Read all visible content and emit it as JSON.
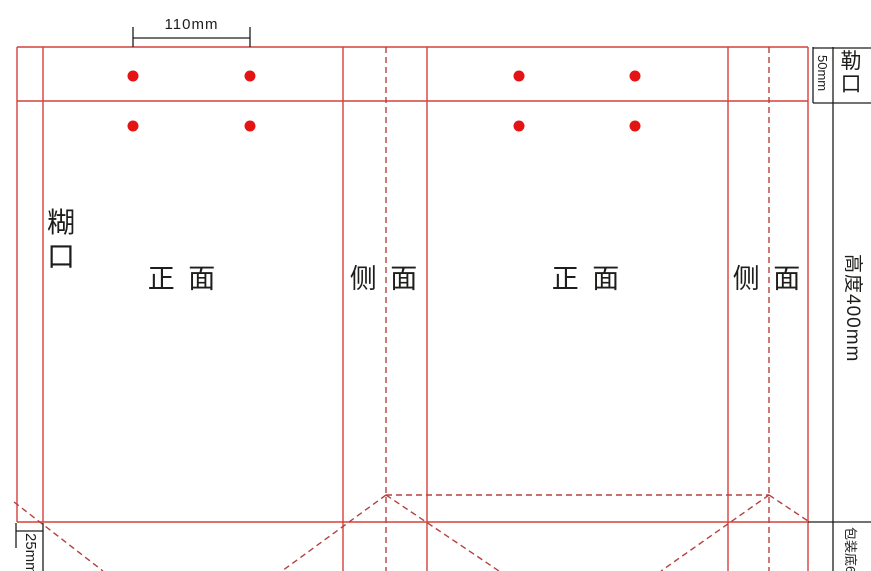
{
  "colors": {
    "red_line": "#d6403c",
    "red_dash": "#b5413f",
    "dot": "#e41414",
    "black": "#1d1d1b"
  },
  "labels": {
    "top_dimension": "110mm",
    "lekou": "勒口",
    "lekou_height": "50mm",
    "glue_flap": "糊口",
    "glue_flap_width": "25mm",
    "front_panel_1": "正 面",
    "side_panel_1": "侧 面",
    "front_panel_2": "正 面",
    "side_panel_2": "侧 面",
    "bag_height": "高度400mm",
    "bag_bottom": "包装底65"
  },
  "diagram": {
    "width": 871,
    "height": 571,
    "lines": [
      {
        "name": "top-edge-fold-line",
        "x1": 17,
        "y1": 47,
        "x2": 808,
        "y2": 47,
        "color": "red_line",
        "dashed": false
      },
      {
        "name": "lekou-fold-line",
        "x1": 17,
        "y1": 101,
        "x2": 808,
        "y2": 101,
        "color": "red_line",
        "dashed": false
      },
      {
        "name": "bottom-fold-line",
        "x1": 17,
        "y1": 522,
        "x2": 808,
        "y2": 522,
        "color": "red_line",
        "dashed": false
      },
      {
        "name": "glue-flap-left-edge",
        "x1": 17,
        "y1": 47,
        "x2": 17,
        "y2": 522,
        "color": "red_line",
        "dashed": false
      },
      {
        "name": "glue-flap-fold-line",
        "x1": 43,
        "y1": 47,
        "x2": 43,
        "y2": 522,
        "color": "red_line",
        "dashed": false
      },
      {
        "name": "front1-side1-fold-line",
        "x1": 343,
        "y1": 47,
        "x2": 343,
        "y2": 571,
        "color": "red_line",
        "dashed": false
      },
      {
        "name": "side1-front2-fold-line",
        "x1": 427,
        "y1": 47,
        "x2": 427,
        "y2": 571,
        "color": "red_line",
        "dashed": false
      },
      {
        "name": "front2-side2-fold-line",
        "x1": 728,
        "y1": 47,
        "x2": 728,
        "y2": 571,
        "color": "red_line",
        "dashed": false
      },
      {
        "name": "right-edge-cut-line",
        "x1": 808,
        "y1": 47,
        "x2": 808,
        "y2": 571,
        "color": "red_line",
        "dashed": false
      },
      {
        "name": "side1-center-fold-dashed",
        "x1": 386,
        "y1": 47,
        "x2": 386,
        "y2": 571,
        "color": "red_dash",
        "dashed": true
      },
      {
        "name": "side2-center-fold-dashed",
        "x1": 769,
        "y1": 47,
        "x2": 769,
        "y2": 571,
        "color": "red_dash",
        "dashed": true
      },
      {
        "name": "bottom-gusset-dashed",
        "x1": 386,
        "y1": 495,
        "x2": 769,
        "y2": 495,
        "color": "red_dash",
        "dashed": true
      },
      {
        "name": "glue-corner-diagonal-dashed",
        "x1": 14,
        "y1": 502,
        "x2": 103,
        "y2": 571,
        "color": "red_dash",
        "dashed": true
      },
      {
        "name": "apex1-left-diagonal-dashed",
        "x1": 386,
        "y1": 495,
        "x2": 282,
        "y2": 571,
        "color": "red_dash",
        "dashed": true
      },
      {
        "name": "apex1-right-diagonal-dashed",
        "x1": 386,
        "y1": 495,
        "x2": 499,
        "y2": 571,
        "color": "red_dash",
        "dashed": true
      },
      {
        "name": "apex2-left-diagonal-dashed",
        "x1": 769,
        "y1": 495,
        "x2": 661,
        "y2": 571,
        "color": "red_dash",
        "dashed": true
      },
      {
        "name": "apex2-right-diagonal-dashed",
        "x1": 769,
        "y1": 495,
        "x2": 808,
        "y2": 521,
        "color": "red_dash",
        "dashed": true
      },
      {
        "name": "annotation-right-vertical",
        "x1": 833,
        "y1": 47,
        "x2": 833,
        "y2": 571,
        "color": "black",
        "dashed": false
      },
      {
        "name": "lekou-bracket-vertical",
        "x1": 813,
        "y1": 47,
        "x2": 813,
        "y2": 103,
        "color": "black",
        "dashed": false
      },
      {
        "name": "lekou-bracket-top",
        "x1": 813,
        "y1": 48,
        "x2": 871,
        "y2": 48,
        "color": "black",
        "dashed": false
      },
      {
        "name": "lekou-bracket-bottom",
        "x1": 813,
        "y1": 103,
        "x2": 871,
        "y2": 103,
        "color": "black",
        "dashed": false
      },
      {
        "name": "bottom-annotation-horizontal",
        "x1": 808,
        "y1": 522,
        "x2": 871,
        "y2": 522,
        "color": "black",
        "dashed": false
      },
      {
        "name": "dim110-line",
        "x1": 133,
        "y1": 38,
        "x2": 250,
        "y2": 38,
        "color": "black",
        "dashed": false
      },
      {
        "name": "dim110-left-tick",
        "x1": 133,
        "y1": 27,
        "x2": 133,
        "y2": 47,
        "color": "black",
        "dashed": false
      },
      {
        "name": "dim110-right-tick",
        "x1": 250,
        "y1": 27,
        "x2": 250,
        "y2": 47,
        "color": "black",
        "dashed": false
      },
      {
        "name": "dim25-bracket-vertical",
        "x1": 43,
        "y1": 523,
        "x2": 43,
        "y2": 571,
        "color": "black",
        "dashed": false
      },
      {
        "name": "dim25-bracket-left",
        "x1": 16,
        "y1": 523,
        "x2": 16,
        "y2": 548,
        "color": "black",
        "dashed": false
      },
      {
        "name": "dim25-bracket-tick",
        "x1": 16,
        "y1": 531,
        "x2": 43,
        "y2": 531,
        "color": "black",
        "dashed": false
      }
    ],
    "dots": {
      "name": "grommet-dot",
      "columns": [
        133,
        250,
        519,
        635
      ],
      "rows": [
        76,
        126
      ],
      "radius": 5.5
    }
  }
}
